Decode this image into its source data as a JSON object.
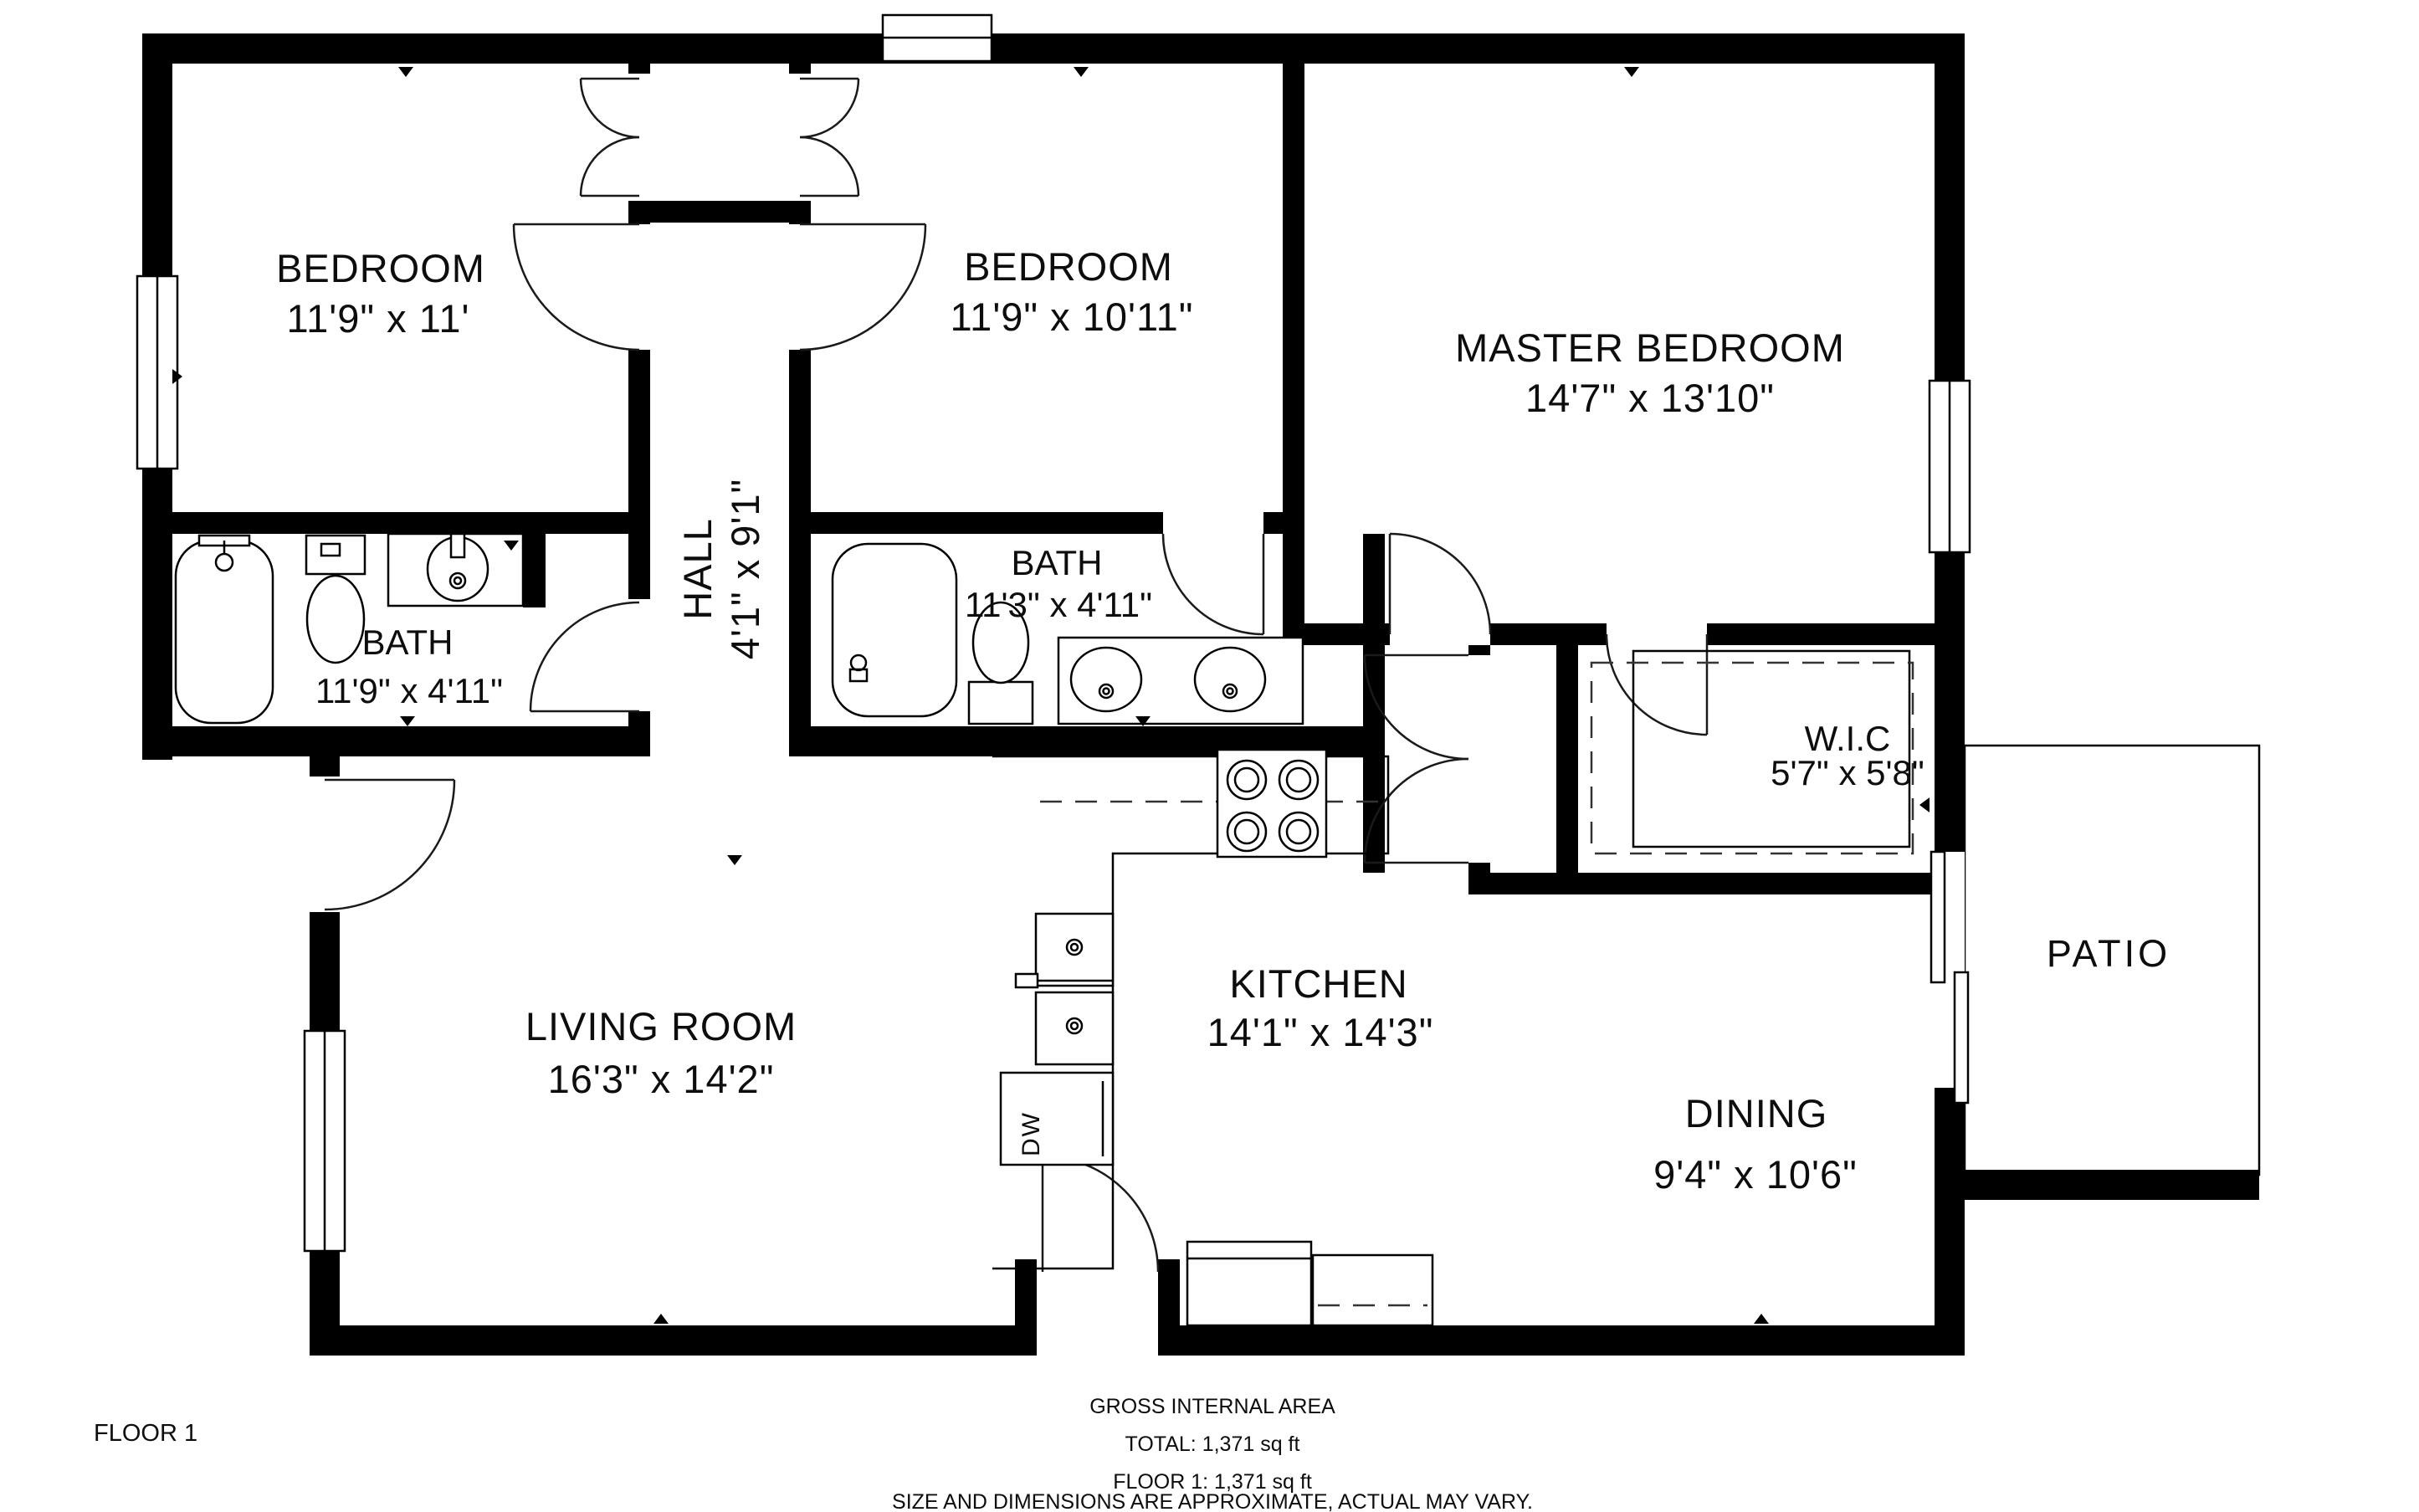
{
  "page": {
    "background": "#ffffff",
    "wall_color": "#000000"
  },
  "floor_plan": {
    "floor_label": "FLOOR 1",
    "rooms": {
      "bedroom1": {
        "name": "BEDROOM",
        "dims": "11'9\" x 11'"
      },
      "bedroom2": {
        "name": "BEDROOM",
        "dims": "11'9\" x 10'11\""
      },
      "master_bedroom": {
        "name": "MASTER BEDROOM",
        "dims": "14'7\" x 13'10\""
      },
      "hall": {
        "name": "HALL",
        "dims": "4'1\" x 9'1\""
      },
      "bath1": {
        "name": "BATH",
        "dims": "11'9\" x 4'11\""
      },
      "bath2": {
        "name": "BATH",
        "dims": "11'3\" x 4'11\""
      },
      "wic": {
        "name": "W.I.C",
        "dims": "5'7\" x 5'8\""
      },
      "living_room": {
        "name": "LIVING ROOM",
        "dims": "16'3\" x 14'2\""
      },
      "kitchen": {
        "name": "KITCHEN",
        "dims": "14'1\" x 14'3\""
      },
      "dining": {
        "name": "DINING",
        "dims": "9'4\" x 10'6\""
      },
      "patio": {
        "name": "PATIO"
      }
    },
    "fixtures": {
      "dishwasher": "DW"
    },
    "footer": {
      "line1": "GROSS INTERNAL AREA",
      "line2": "TOTAL: 1,371 sq ft",
      "line3": "FLOOR 1: 1,371 sq ft",
      "line4": "SIZE AND DIMENSIONS ARE APPROXIMATE, ACTUAL MAY VARY."
    }
  }
}
